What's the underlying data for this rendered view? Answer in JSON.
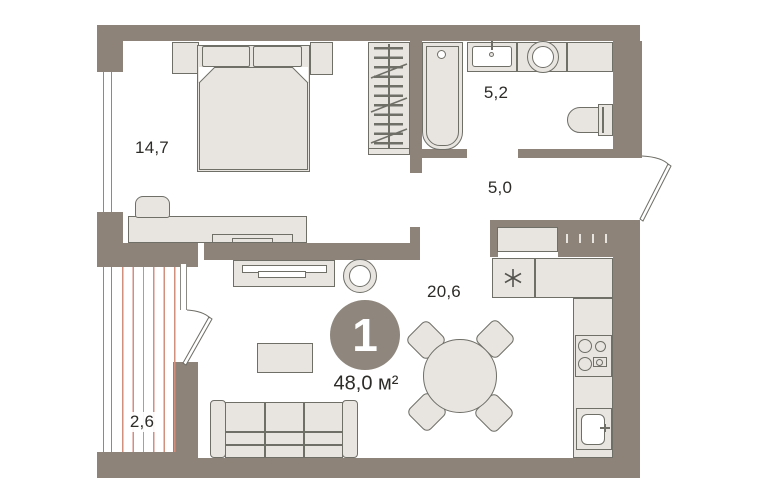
{
  "plan": {
    "unit": {
      "badge": "1",
      "total_area": "48,0 м²"
    },
    "rooms": {
      "bedroom": {
        "area": "14,7"
      },
      "bathroom": {
        "area": "5,2"
      },
      "hallway": {
        "area": "5,0"
      },
      "living_kitchen": {
        "area": "20,6"
      },
      "balcony": {
        "area": "2,6"
      }
    },
    "colors": {
      "wall": "#8d8379",
      "furniture_fill": "#e8e5e0",
      "furniture_stroke": "#6f6e67",
      "balcony_stripe": "#d38f7e",
      "badge_bg": "#8f877d",
      "label_text": "#2d2b27",
      "background": "#ffffff"
    }
  }
}
